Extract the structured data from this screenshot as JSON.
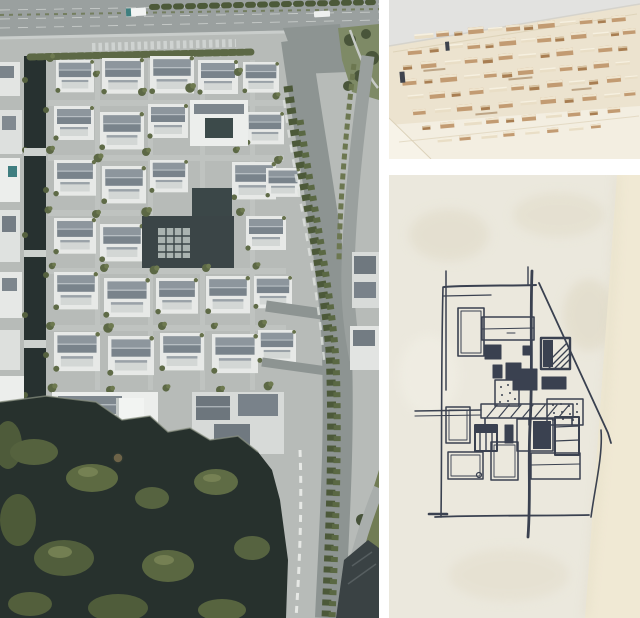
{
  "page": {
    "bg": "#ffffff",
    "gutter": "#ffffff"
  },
  "panels": {
    "aerial": {
      "description": "Aerial drone photo of a courtyard-style campus of white buildings with grey pitched roofs; highway along the top, curving tree-lined ring road on the right, dark lake with green islands at lower left",
      "colors": {
        "paving": "#b7bbb8",
        "highway": "#9aa09f",
        "canal": "#273130",
        "lake": "#27312d",
        "roofDark": "#79838b",
        "buildingWhite": "#e8eae8",
        "tree": "#5c6845",
        "ringRoad": "#8d9492",
        "grass": "#7e8a66"
      }
    },
    "model": {
      "description": "Physical wooden massing model of the masterplan: small timber blocks on a pale wood baseboard, photographed against a light grey wall",
      "colors": {
        "wall": "#e2e2e0",
        "wood": "#ece3cf",
        "woodLight": "#f3eee1",
        "blockFront": "#c29b72",
        "blockTop": "#efe5cf",
        "blockBrown": "#a87e52",
        "blockNavy": "#3e434d"
      }
    },
    "sketch": {
      "description": "Hand-drawn felt-pen concept plan sketch on cream textured paper; rectangular rooms, hatched and solid squares, pergola band, long vertical axis line and diagonal site edge",
      "colors": {
        "paper": "#ebe8dd",
        "paperEdge": "#f0e9d4",
        "smudge": "#ded8c4",
        "ink": "#3a4150"
      }
    }
  }
}
